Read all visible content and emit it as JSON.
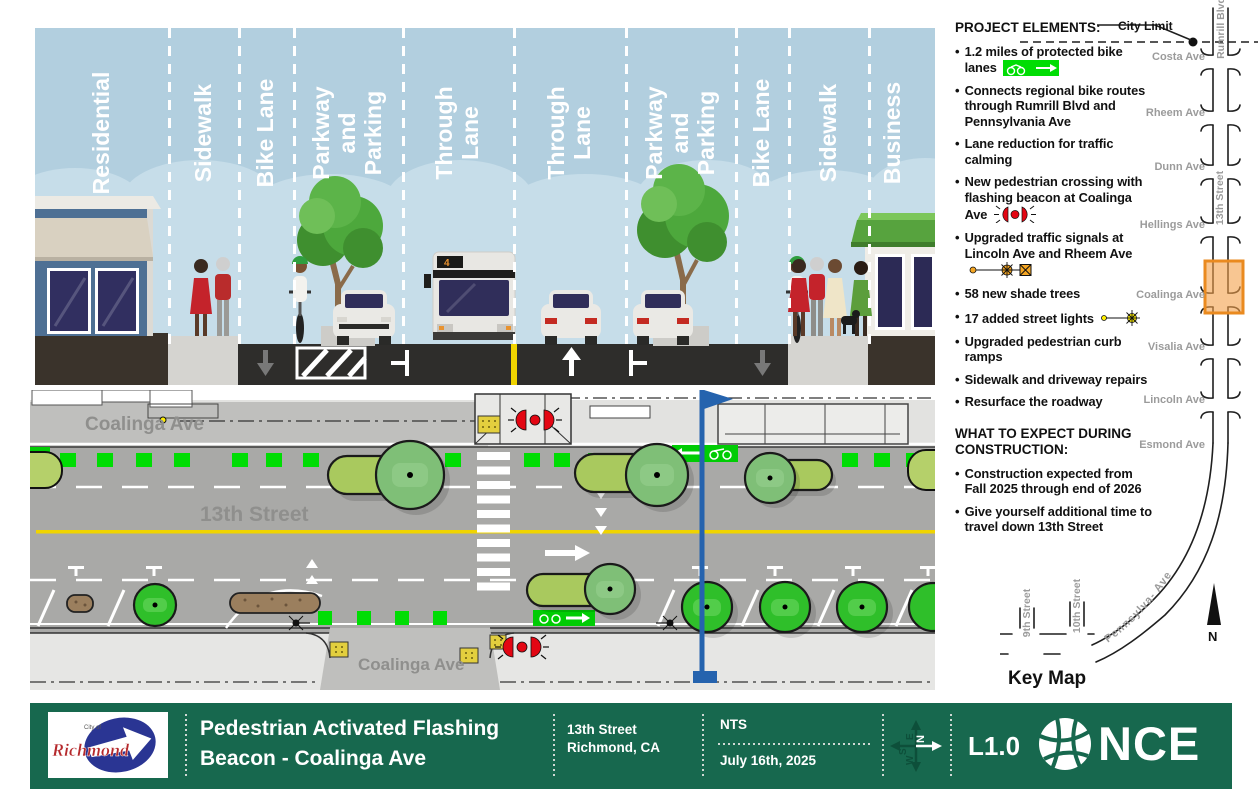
{
  "colors": {
    "sheet_green": "#17684e",
    "bike_green": "#00dd04",
    "beacon_red": "#e30613",
    "highlight_orange": "#f09a3d",
    "sky_blue": "#b7d3e2",
    "road_dark": "#2e2d2b",
    "plan_road_gray": "#a9a9a7",
    "center_yellow": "#f0d400",
    "section_marker_blue": "#2563ae"
  },
  "cross_section": {
    "lane_labels": [
      "Residential",
      "Sidewalk",
      "Bike Lane",
      "Parkway\nand\nParking",
      "Through\nLane",
      "Through\nLane",
      "Parkway\nand\nParking",
      "Bike Lane",
      "Sidewalk",
      "Business"
    ],
    "bus_route_number": "4"
  },
  "plan_view": {
    "street_label": "13th Street",
    "cross_street_top_label": "Coalinga Ave",
    "cross_street_bottom_label": "Coalinga Ave"
  },
  "project_elements": {
    "heading": "PROJECT ELEMENTS:",
    "items": [
      {
        "text": "1.2 miles of protected bike lanes",
        "icon": "protected-bike-lane-icon"
      },
      {
        "text": "Connects regional bike routes through Rumrill Blvd and Pennsylvania Ave",
        "icon": null
      },
      {
        "text": "Lane reduction for traffic calming",
        "icon": null
      },
      {
        "text": "New pedestrian crossing with flashing beacon at Coalinga Ave",
        "icon": "flashing-beacon-icon"
      },
      {
        "text": "Upgraded traffic signals at Lincoln Ave and Rheem Ave",
        "icon": "traffic-signal-icon"
      },
      {
        "text": "58 new shade trees",
        "icon": null
      },
      {
        "text": "17 added street lights",
        "icon": "street-light-icon"
      },
      {
        "text": "Upgraded pedestrian curb ramps",
        "icon": null
      },
      {
        "text": "Sidewalk and driveway repairs",
        "icon": null
      },
      {
        "text": "Resurface the roadway",
        "icon": null
      }
    ]
  },
  "construction": {
    "heading": "WHAT TO EXPECT DURING CONSTRUCTION:",
    "items": [
      "Construction expected from Fall 2025 through end of 2026",
      "Give yourself additional time to travel down 13th Street"
    ]
  },
  "key_map": {
    "heading": "Key Map",
    "city_limit_label": "City Limit",
    "north_label": "N",
    "main_street_label": "13th Street",
    "north_street_label": "Rumrill Blvd",
    "curved_street_label": "Pennsylva- Ave",
    "cross_streets": [
      "Costa Ave",
      "Rheem Ave",
      "Dunn Ave",
      "Hellings Ave",
      "Coalinga Ave",
      "Visalia Ave",
      "Lincoln Ave",
      "Esmond Ave"
    ],
    "south_streets": [
      "9th Street",
      "10th Street"
    ]
  },
  "title_block": {
    "agency_logo_text": "Richmond",
    "agency_logo_small_text": "City of",
    "project_title_line1": "Pedestrian Activated Flashing",
    "project_title_line2": "Beacon - Coalinga Ave",
    "location_line1": "13th Street",
    "location_line2": "Richmond, CA",
    "scale": "NTS",
    "date": "July 16th, 2025",
    "sheet_number": "L1.0",
    "firm_name": "NCE",
    "compass": {
      "up": "E",
      "right": "N",
      "down": "W",
      "left": "S"
    }
  }
}
